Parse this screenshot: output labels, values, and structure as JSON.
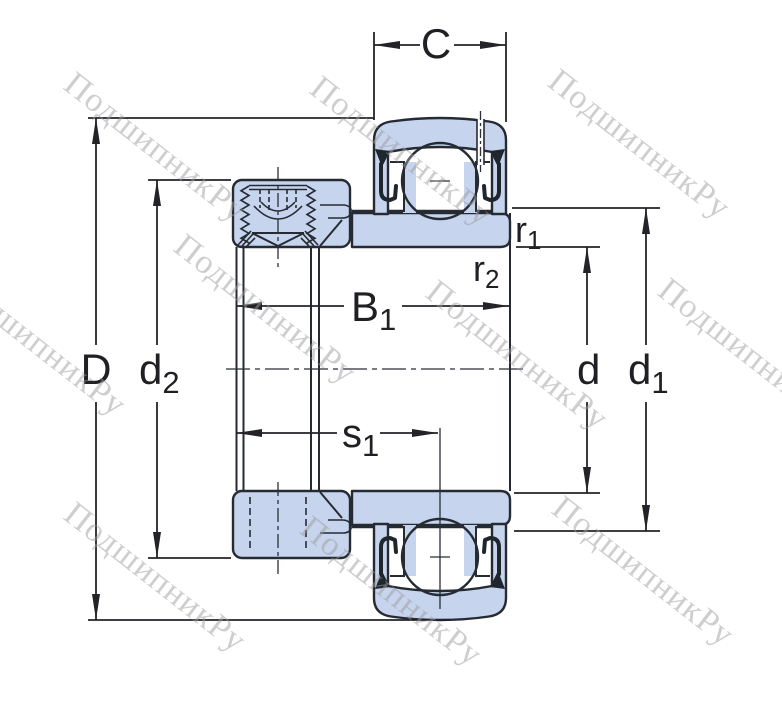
{
  "page": {
    "description": "Technical cross-section drawing of an insert ball bearing (Y-bearing) with eccentric locking collar and dimension callouts"
  },
  "watermark": {
    "text": "ПодшипникРу",
    "color": "#9e9e9e"
  },
  "drawing": {
    "part_fill": "#c6d4ee",
    "line_color": "#262b33",
    "dim_color": "#232328"
  },
  "dimensions": {
    "C": {
      "label": "C"
    },
    "D": {
      "label": "D"
    },
    "d2": {
      "base": "d",
      "sub": "2"
    },
    "B1": {
      "base": "B",
      "sub": "1"
    },
    "s1": {
      "base": "s",
      "sub": "1"
    },
    "r1": {
      "base": "r",
      "sub": "1"
    },
    "r2": {
      "base": "r",
      "sub": "2"
    },
    "d": {
      "label": "d"
    },
    "d1": {
      "base": "d",
      "sub": "1"
    }
  }
}
